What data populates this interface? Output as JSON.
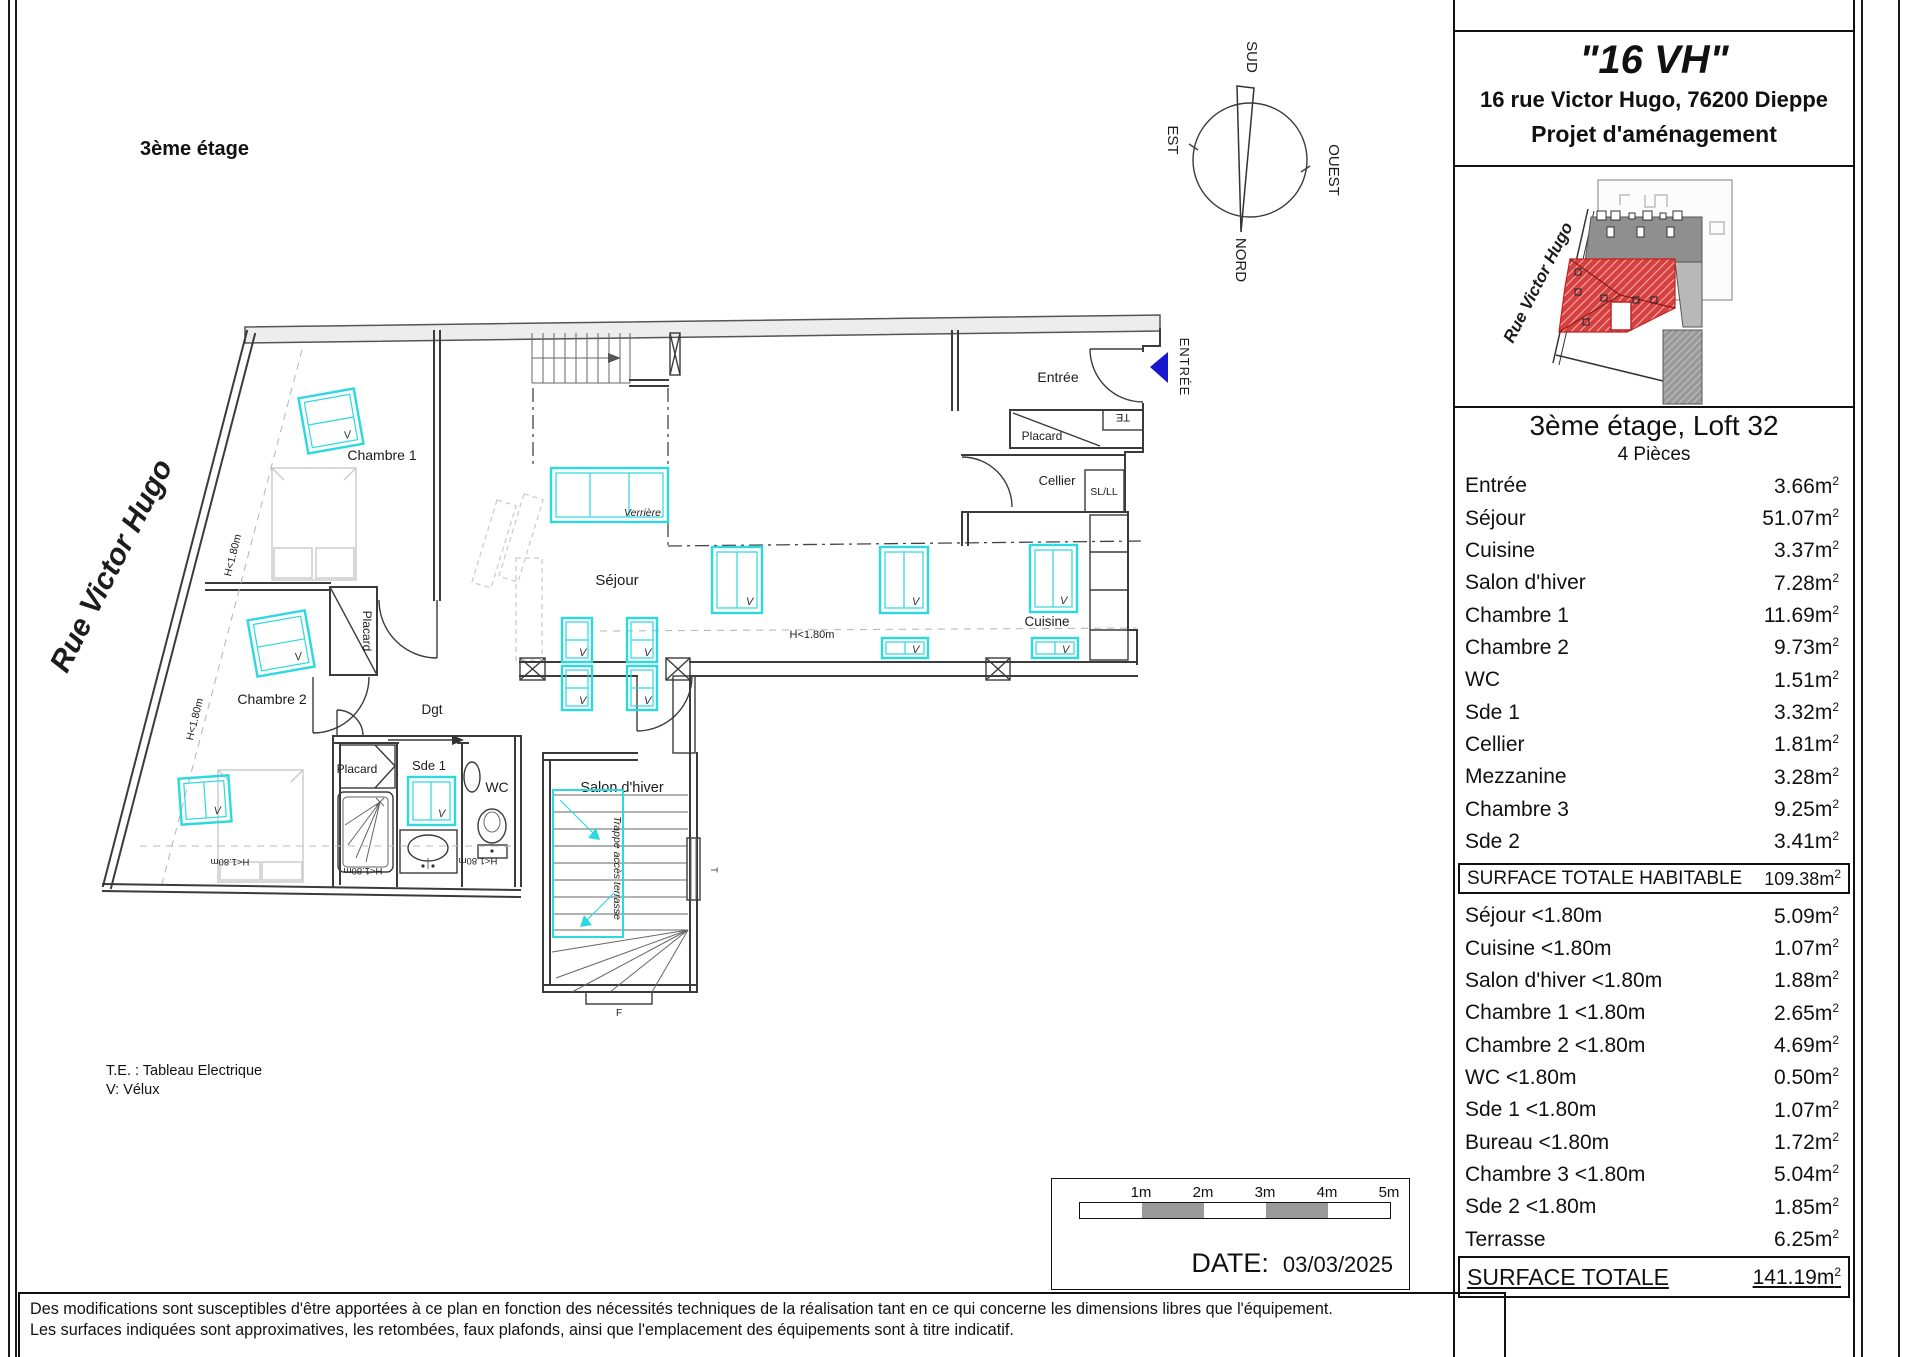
{
  "header": {
    "floor": "3ème étage"
  },
  "title_block": {
    "title": "\"16 VH\"",
    "address": "16 rue Victor Hugo, 76200 Dieppe",
    "project": "Projet d'aménagement"
  },
  "unit": {
    "title": "3ème étage, Loft 32",
    "subtitle": "4 Pièces"
  },
  "areas": {
    "unit": "m",
    "sup": "2",
    "rows": [
      {
        "label": "Entrée",
        "value": "3.66"
      },
      {
        "label": "Séjour",
        "value": "51.07"
      },
      {
        "label": "Cuisine",
        "value": "3.37"
      },
      {
        "label": "Salon d'hiver",
        "value": "7.28"
      },
      {
        "label": "Chambre 1",
        "value": "11.69"
      },
      {
        "label": "Chambre 2",
        "value": "9.73"
      },
      {
        "label": "WC",
        "value": "1.51"
      },
      {
        "label": "Sde 1",
        "value": "3.32"
      },
      {
        "label": "Cellier",
        "value": "1.81"
      },
      {
        "label": "Mezzanine",
        "value": "3.28"
      },
      {
        "label": "Chambre 3",
        "value": "9.25"
      },
      {
        "label": "Sde 2",
        "value": "3.41"
      }
    ],
    "habitable": {
      "label": "SURFACE TOTALE HABITABLE",
      "value": "109.38"
    },
    "low_rows": [
      {
        "label": "Séjour <1.80m",
        "value": "5.09"
      },
      {
        "label": "Cuisine <1.80m",
        "value": "1.07"
      },
      {
        "label": "Salon d'hiver <1.80m",
        "value": "1.88"
      },
      {
        "label": "Chambre 1 <1.80m",
        "value": "2.65"
      },
      {
        "label": "Chambre 2 <1.80m",
        "value": "4.69"
      },
      {
        "label": "WC  <1.80m",
        "value": "0.50"
      },
      {
        "label": "Sde 1 <1.80m",
        "value": "1.07"
      },
      {
        "label": "Bureau <1.80m",
        "value": "1.72"
      },
      {
        "label": "Chambre 3  <1.80m",
        "value": "5.04"
      },
      {
        "label": "Sde 2 <1.80m",
        "value": "1.85"
      },
      {
        "label": "Terrasse",
        "value": "6.25"
      }
    ],
    "total": {
      "label": "SURFACE TOTALE",
      "value": "141.19"
    }
  },
  "plan": {
    "street": "Rue Victor Hugo",
    "rooms": {
      "chambre1": "Chambre 1",
      "chambre2": "Chambre 2",
      "sejour": "Séjour",
      "salon": "Salon d'hiver",
      "cuisine": "Cuisine",
      "cellier": "Cellier",
      "entree": "Entrée",
      "dgt": "Dgt",
      "sde1": "Sde 1",
      "wc": "WC",
      "placard": "Placard",
      "sl": "SL/LL"
    },
    "tags": {
      "v": "V",
      "te": "TE",
      "verriere": "Verrière",
      "trappe": "Trappe accès terrasse",
      "h180": "H<1.80m",
      "entree_arrow": "ENTRÉE",
      "f": "F",
      "t": "T"
    }
  },
  "compass": {
    "n": "NORD",
    "s": "SUD",
    "e": "EST",
    "w": "OUEST"
  },
  "legend": {
    "line1": "T.E. : Tableau Electrique",
    "line2": "V: Vélux"
  },
  "scalebar": {
    "labels": [
      "1m",
      "2m",
      "3m",
      "4m",
      "5m"
    ]
  },
  "date": {
    "label": "DATE:",
    "value": "03/03/2025"
  },
  "disclaimer": {
    "line1": "Des modifications sont  susceptibles d'être apportées  à ce plan en fonction des nécessités techniques de la réalisation tant en ce qui concerne les dimensions libres que l'équipement.",
    "line2": "Les surfaces indiquées sont approximatives, les retombées, faux plafonds, ainsi que l'emplacement des équipements sont à titre indicatif."
  },
  "colors": {
    "velux": "#2BD9DE",
    "entry_arrow": "#1717CD",
    "te_red": "#C42222",
    "loft_red": "#D84040"
  }
}
